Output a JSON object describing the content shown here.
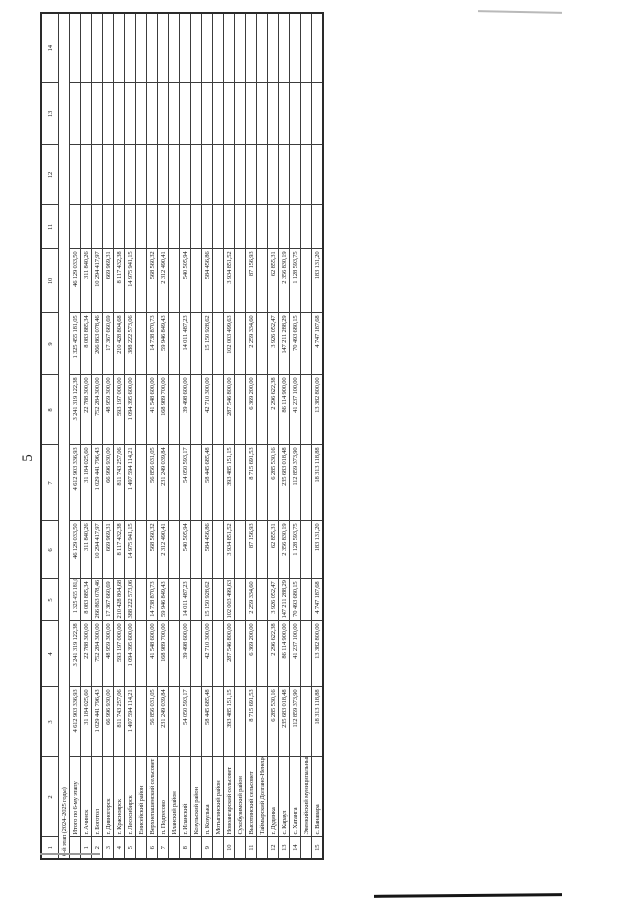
{
  "page": {
    "number": "5"
  },
  "table": {
    "column_numbers": [
      "1",
      "2",
      "3",
      "4",
      "5",
      "6",
      "7",
      "8",
      "9",
      "10",
      "11",
      "12",
      "13",
      "14"
    ],
    "rows": [
      {
        "type": "stage",
        "name": "6-й этап (2024–2025 годы)"
      },
      {
        "type": "total",
        "num": "",
        "name": "Итого по 6-му этапу",
        "values": [
          "4 612 903 336,93",
          "3 241 319 122,38",
          "1 325 455 181,05",
          "46 129 033,50",
          "4 612 903 336,93",
          "3 241 319 122,38",
          "1 325 455 181,05",
          "46 129 033,50"
        ]
      },
      {
        "type": "data",
        "num": "1",
        "name": "г. Ачинск",
        "values": [
          "31 184 025,60",
          "22 788 300,00",
          "8 083 885,34",
          "311 840,26",
          "31 184 025,60",
          "22 788 300,00",
          "8 083 885,34",
          "311 840,26"
        ]
      },
      {
        "type": "data",
        "num": "2",
        "name": "г. Боготол",
        "values": [
          "1 029 441 796,43",
          "752 284 300,00",
          "266 863 078,46",
          "10 294 417,97",
          "1 029 441 796,43",
          "752 284 300,00",
          "266 863 078,46",
          "10 294 417,97"
        ]
      },
      {
        "type": "data",
        "num": "3",
        "name": "г. Дивногорск",
        "values": [
          "66 996 930,00",
          "48 959 300,00",
          "17 367 660,69",
          "669 969,31",
          "66 996 930,00",
          "48 959 300,00",
          "17 367 660,69",
          "669 969,31"
        ]
      },
      {
        "type": "data",
        "num": "4",
        "name": "г. Красноярск",
        "values": [
          "811 743 257,06",
          "593 197 000,00",
          "210 428 804,68",
          "8 117 432,38",
          "811 743 257,06",
          "593 197 000,00",
          "210 428 804,68",
          "8 117 432,38"
        ]
      },
      {
        "type": "data",
        "num": "5",
        "name": "г. Лесосибирск",
        "values": [
          "1 497 594 114,21",
          "1 094 395 600,00",
          "388 222 573,06",
          "14 975 941,15",
          "1 497 594 114,21",
          "1 094 395 600,00",
          "388 222 573,06",
          "14 975 941,15"
        ]
      },
      {
        "type": "group",
        "name": "Енисейский район"
      },
      {
        "type": "data",
        "num": "6",
        "name": "Верхнепашенский сельсовет",
        "values": [
          "56 856 031,05",
          "41 548 600,00",
          "14 738 870,73",
          "568 560,32",
          "56 856 031,05",
          "41 548 600,00",
          "14 738 870,73",
          "568 560,32"
        ]
      },
      {
        "type": "data",
        "num": "7",
        "name": "п. Подтесово",
        "values": [
          "231 249 039,84",
          "168 989 700,00",
          "59 946 849,43",
          "2 312 490,41",
          "231 249 039,84",
          "168 989 700,00",
          "59 946 849,43",
          "2 312 490,41"
        ]
      },
      {
        "type": "group",
        "name": "Иланский район"
      },
      {
        "type": "data",
        "num": "8",
        "name": "г. Иланский",
        "values": [
          "54 050 593,17",
          "39 498 600,00",
          "14 011 487,23",
          "540 505,94",
          "54 050 593,17",
          "39 498 600,00",
          "14 011 487,23",
          "540 505,94"
        ]
      },
      {
        "type": "group",
        "name": "Козульский район"
      },
      {
        "type": "data",
        "num": "9",
        "name": "п. Козулька",
        "values": [
          "58 445 685,48",
          "42 710 300,00",
          "15 150 928,62",
          "584 456,86",
          "58 445 685,48",
          "42 710 300,00",
          "15 150 928,62",
          "584 456,86"
        ]
      },
      {
        "type": "group",
        "name": "Мотыгинский район"
      },
      {
        "type": "data",
        "num": "10",
        "name": "Новоангарский сельсовет",
        "values": [
          "393 485 151,15",
          "287 546 800,00",
          "102 003 499,63",
          "3 934 851,52",
          "393 485 151,15",
          "287 546 800,00",
          "102 003 499,63",
          "3 934 851,52"
        ]
      },
      {
        "type": "group",
        "name": "Сухобузимский район"
      },
      {
        "type": "data",
        "num": "11",
        "name": "Высотинский сельсовет",
        "values": [
          "8 715 691,53",
          "6 369 200,00",
          "2 259 334,60",
          "87 156,93",
          "8 715 691,53",
          "6 369 200,00",
          "2 259 334,60",
          "87 156,93"
        ]
      },
      {
        "type": "group",
        "name": "Таймырский Долгано-Ненецкий муниципальный район"
      },
      {
        "type": "data",
        "num": "12",
        "name": "г. Дудинка",
        "values": [
          "6 285 530,16",
          "2 296 622,38",
          "3 926 052,47",
          "62 855,31",
          "6 285 530,16",
          "2 296 622,38",
          "3 926 052,47",
          "62 855,31"
        ]
      },
      {
        "type": "data",
        "num": "13",
        "name": "с. Караул",
        "values": [
          "235 683 018,48",
          "86 114 900,00",
          "147 211 288,29",
          "2 356 830,19",
          "235 683 018,48",
          "86 114 900,00",
          "147 211 288,29",
          "2 356 830,19"
        ]
      },
      {
        "type": "data",
        "num": "14",
        "name": "с. Хатанга",
        "values": [
          "112 859 373,90",
          "41 237 100,00",
          "70 493 680,15",
          "1 128 593,75",
          "112 859 373,90",
          "41 237 100,00",
          "70 493 680,15",
          "1 128 593,75"
        ]
      },
      {
        "type": "group",
        "name": "Эвенкийский муниципальный район"
      },
      {
        "type": "data",
        "num": "15",
        "name": "с. Ванавара",
        "values": [
          "18 313 118,88",
          "13 382 800,00",
          "4 747 187,68",
          "183 131,20",
          "18 313 118,88",
          "13 382 800,00",
          "4 747 187,68",
          "183 131,20"
        ]
      }
    ]
  }
}
